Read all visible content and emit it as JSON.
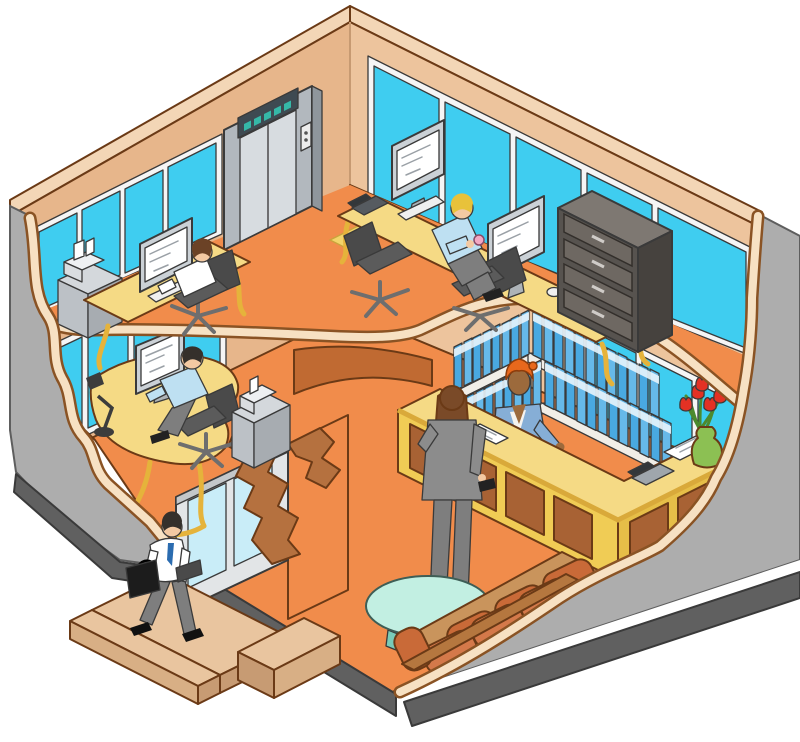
{
  "scene": {
    "description": "isometric-cutaway-illustration-of-two-storey-office",
    "upper_floor": {
      "objects": [
        "elevator",
        "window-wall-left",
        "window-wall-right",
        "desk-upper-left",
        "long-desk-center",
        "office-chairs",
        "computer-monitors",
        "desk-phone",
        "filing-cabinet",
        "copier-on-cabinet",
        "floor-mat"
      ],
      "people": [
        {
          "name": "worker-at-left-desk",
          "shirt": "white",
          "hair": "brown"
        },
        {
          "name": "worker-at-center-desk",
          "shirt": "light-blue",
          "hair": "blond"
        }
      ]
    },
    "ground_floor": {
      "objects": [
        "reception-counter",
        "binder-wall-shelves",
        "flower-vase",
        "reception-phone",
        "guest-ledger",
        "sofa",
        "glass-coffee-table",
        "corner-desk",
        "desk-lamp",
        "computer-monitor",
        "storage-cabinet",
        "printer",
        "sliding-glass-entrance",
        "entrance-steps"
      ],
      "people": [
        {
          "name": "receptionist",
          "jacket": "light-blue",
          "headwrap": "orange"
        },
        {
          "name": "visitor-woman",
          "suit": "gray",
          "hair": "auburn"
        },
        {
          "name": "worker-at-corner-desk",
          "shirt": "light-blue",
          "hair": "dark"
        }
      ]
    },
    "exterior": {
      "people": [
        {
          "name": "man-leaving-with-briefcase",
          "shirt": "white",
          "tie": "blue",
          "trousers": "gray"
        }
      ]
    },
    "counts": {
      "people_total": 6,
      "binder_rows": 4,
      "upper_window_panes_left": 4,
      "upper_window_panes_right": 5,
      "reception_panels": 6,
      "file_drawers": 4
    }
  },
  "palette": {
    "outline": "#3A3A3A",
    "outlineBrown": "#6B3A16",
    "floor": "#F18C4B",
    "wallBand": "#F3D6B6",
    "wallFace": "#E7B68B",
    "wallFaceRight": "#EDC49D",
    "cutCream": "#F7E1C3",
    "cutOutline": "#8A5324",
    "glass": "#3FCDF0",
    "glassDoor": "#C9EDF8",
    "winFrame": "#F5F5F5",
    "outerWall": "#ADADAD",
    "foundation": "#606060",
    "deskTop": "#F5DA85",
    "deskLeg": "#E5B33B",
    "counterFront": "#F0CC55",
    "counterSide": "#E6BE48",
    "counterTrim": "#D9A93A",
    "panelBrown": "#A86234",
    "shelf": "#F1EEE7",
    "binder": "#49A9E1",
    "binder2": "#66B9E9",
    "binderLabel": "#E8F4FC",
    "chair": "#5B5B5B",
    "chair2": "#4A4A4A",
    "chairStem": "#6E6E6E",
    "monitorFrame": "#CBD1D6",
    "screen": "#FFFFFF",
    "screenSketch": "#9AA0A6",
    "cabinetTop": "#D4D8DC",
    "cabinetFront": "#BCC1C6",
    "cabinetSide": "#A7ACB1",
    "fileTop": "#7E7872",
    "fileFront": "#57534F",
    "fileSide": "#46423E",
    "fileDrawer": "#6E6862",
    "elevFrame": "#B2B8BE",
    "elevFrameSide": "#8F969C",
    "elevDoor": "#D7DCE0",
    "elevHeader": "#3E4A52",
    "elevLight": "#35B8A8",
    "mat": "#F2D46A",
    "matEdge": "#C9A43C",
    "sofaCushion": "#D4794A",
    "sofaCushion2": "#C96A38",
    "sofaWood": "#C9945C",
    "sofaBack": "#B5773F",
    "tableMint": "#C2EFE2",
    "tableLeg": "#79CBB8",
    "vase": "#8CC053",
    "tulip": "#E33124",
    "stem": "#4C8A2E",
    "skin": "#F3C9A2",
    "skinDark": "#9C6A3C",
    "hairBrown": "#6B4226",
    "hairDark": "#35302B",
    "hairBlond": "#E8C23A",
    "hairAuburn": "#7A4A28",
    "shirtWhite": "#FFFFFF",
    "shirtBlue": "#BEE0F2",
    "jacketBlue": "#86AED6",
    "headwrap": "#E8681C",
    "suitGray": "#8C8C8C",
    "pants": "#7E7E7E",
    "tie": "#2B6CB0",
    "case": "#1C1C1C",
    "stepTop": "#E9C59F",
    "stepFront": "#D8AF85",
    "stepSide": "#C79B73",
    "wedgeBrown": "#C06A32",
    "partitionBrown": "#B5713F",
    "doorFrame": "#E2E5E7",
    "paper": "#FFFFFF",
    "phoneBody": "#565B60",
    "phoneDark": "#33373A",
    "phoneGray": "#9FA6AC",
    "cup": "#F2A8C4"
  }
}
